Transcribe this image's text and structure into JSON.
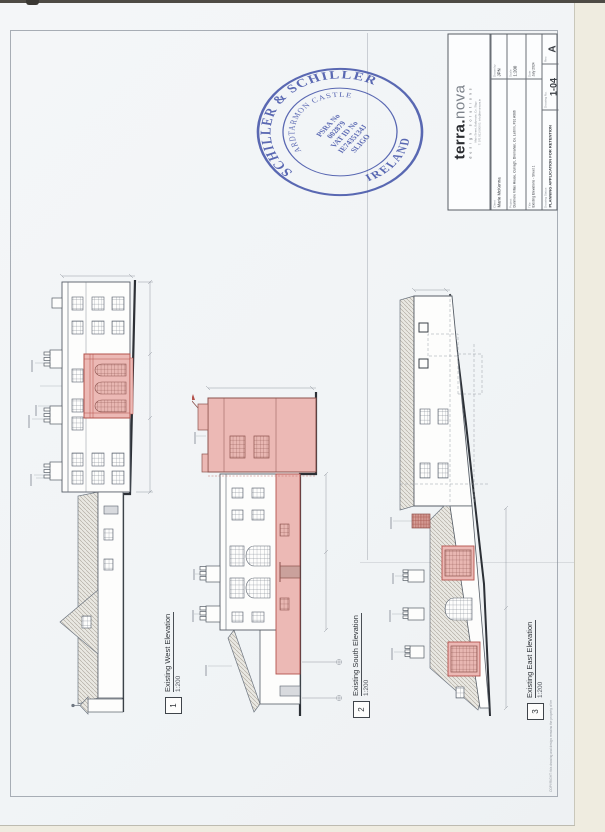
{
  "document": {
    "edge_note": "COPYRIGHT: this drawing and design remains the property of terra.nova design solutions"
  },
  "stamp": {
    "arc_top": "SCHILLER & SCHILLER",
    "arc_inner": "ARDTARMON CASTLE",
    "arc_bottom": "IRELAND",
    "line1": "PSRA No",
    "line2": "002879",
    "line3": "VAT ID No",
    "line4": "IE7435134J",
    "line5": "SLIGO",
    "color": "#3d4ea6"
  },
  "title_block": {
    "logo_terra": "terra",
    "logo_dot": ".",
    "logo_nova": "nova",
    "tagline": "design solutions",
    "address_line1": "Main Street, Ballymote, Co. Sligo",
    "address_line2": "T: 071 911 0000   E: info@terranova.ie",
    "fields": {
      "client_label": "Client",
      "client": "Marie McKenna",
      "project_label": "Project",
      "project": "Dunmore Villas House, Curragh, Dromahair, Co. Leitrim, F91 A086",
      "title_label": "Title",
      "title": "Existing Elevations - Sheet 1",
      "status_label": "Drawing Status",
      "status": "PLANNING APPLICATION FOR RETENTION",
      "drawn_label": "Drawn by",
      "drawn": "JPN",
      "scale_label": "Scale",
      "scale": "1:200",
      "date_label": "Date",
      "date": "July 2024",
      "number_label": "Drawing No.",
      "number": "1-04",
      "rev_label": "Rev.",
      "rev": "A"
    }
  },
  "elevations": [
    {
      "num": "1",
      "label": "Existing West Elevation",
      "scale": "1:200"
    },
    {
      "num": "2",
      "label": "Existing South Elevation",
      "scale": "1:200"
    },
    {
      "num": "3",
      "label": "Existing East Elevation",
      "scale": "1:200"
    }
  ],
  "colors": {
    "highlight_fill": "#ecb9b5",
    "highlight_line": "#b4524c",
    "line": "#6e7681",
    "ground": "#2c3036"
  }
}
